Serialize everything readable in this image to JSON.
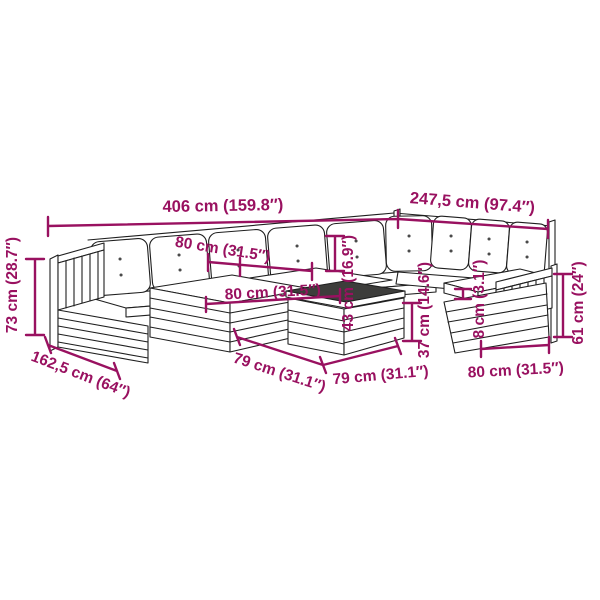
{
  "diagram": {
    "title": "Garden pallet lounge set dimension diagram",
    "colors": {
      "accent": "#991160",
      "line": "#1f1f1f",
      "table_top": "#3d3d3b",
      "dot": "#4a4a4a"
    },
    "dimensions": {
      "overall_width": "406 cm (159.8″)",
      "overall_depth": "247,5 cm (97.4″)",
      "back_cushion_width": "80 cm (31.5″)",
      "module_width": "80 cm (31.5″)",
      "back_cushion_height": "43 cm (16.9″)",
      "seat_height": "37 cm (14.6″)",
      "cushion_thickness": "8 cm (3.1″)",
      "armrest_height": "61 cm (24″)",
      "total_height": "73 cm (28.7″)",
      "side_depth": "162,5 cm (64″)",
      "table_depth": "79 cm (31.1″)",
      "table_width": "79 cm (31.1″)",
      "right_module_width": "80 cm (31.5″)"
    }
  }
}
